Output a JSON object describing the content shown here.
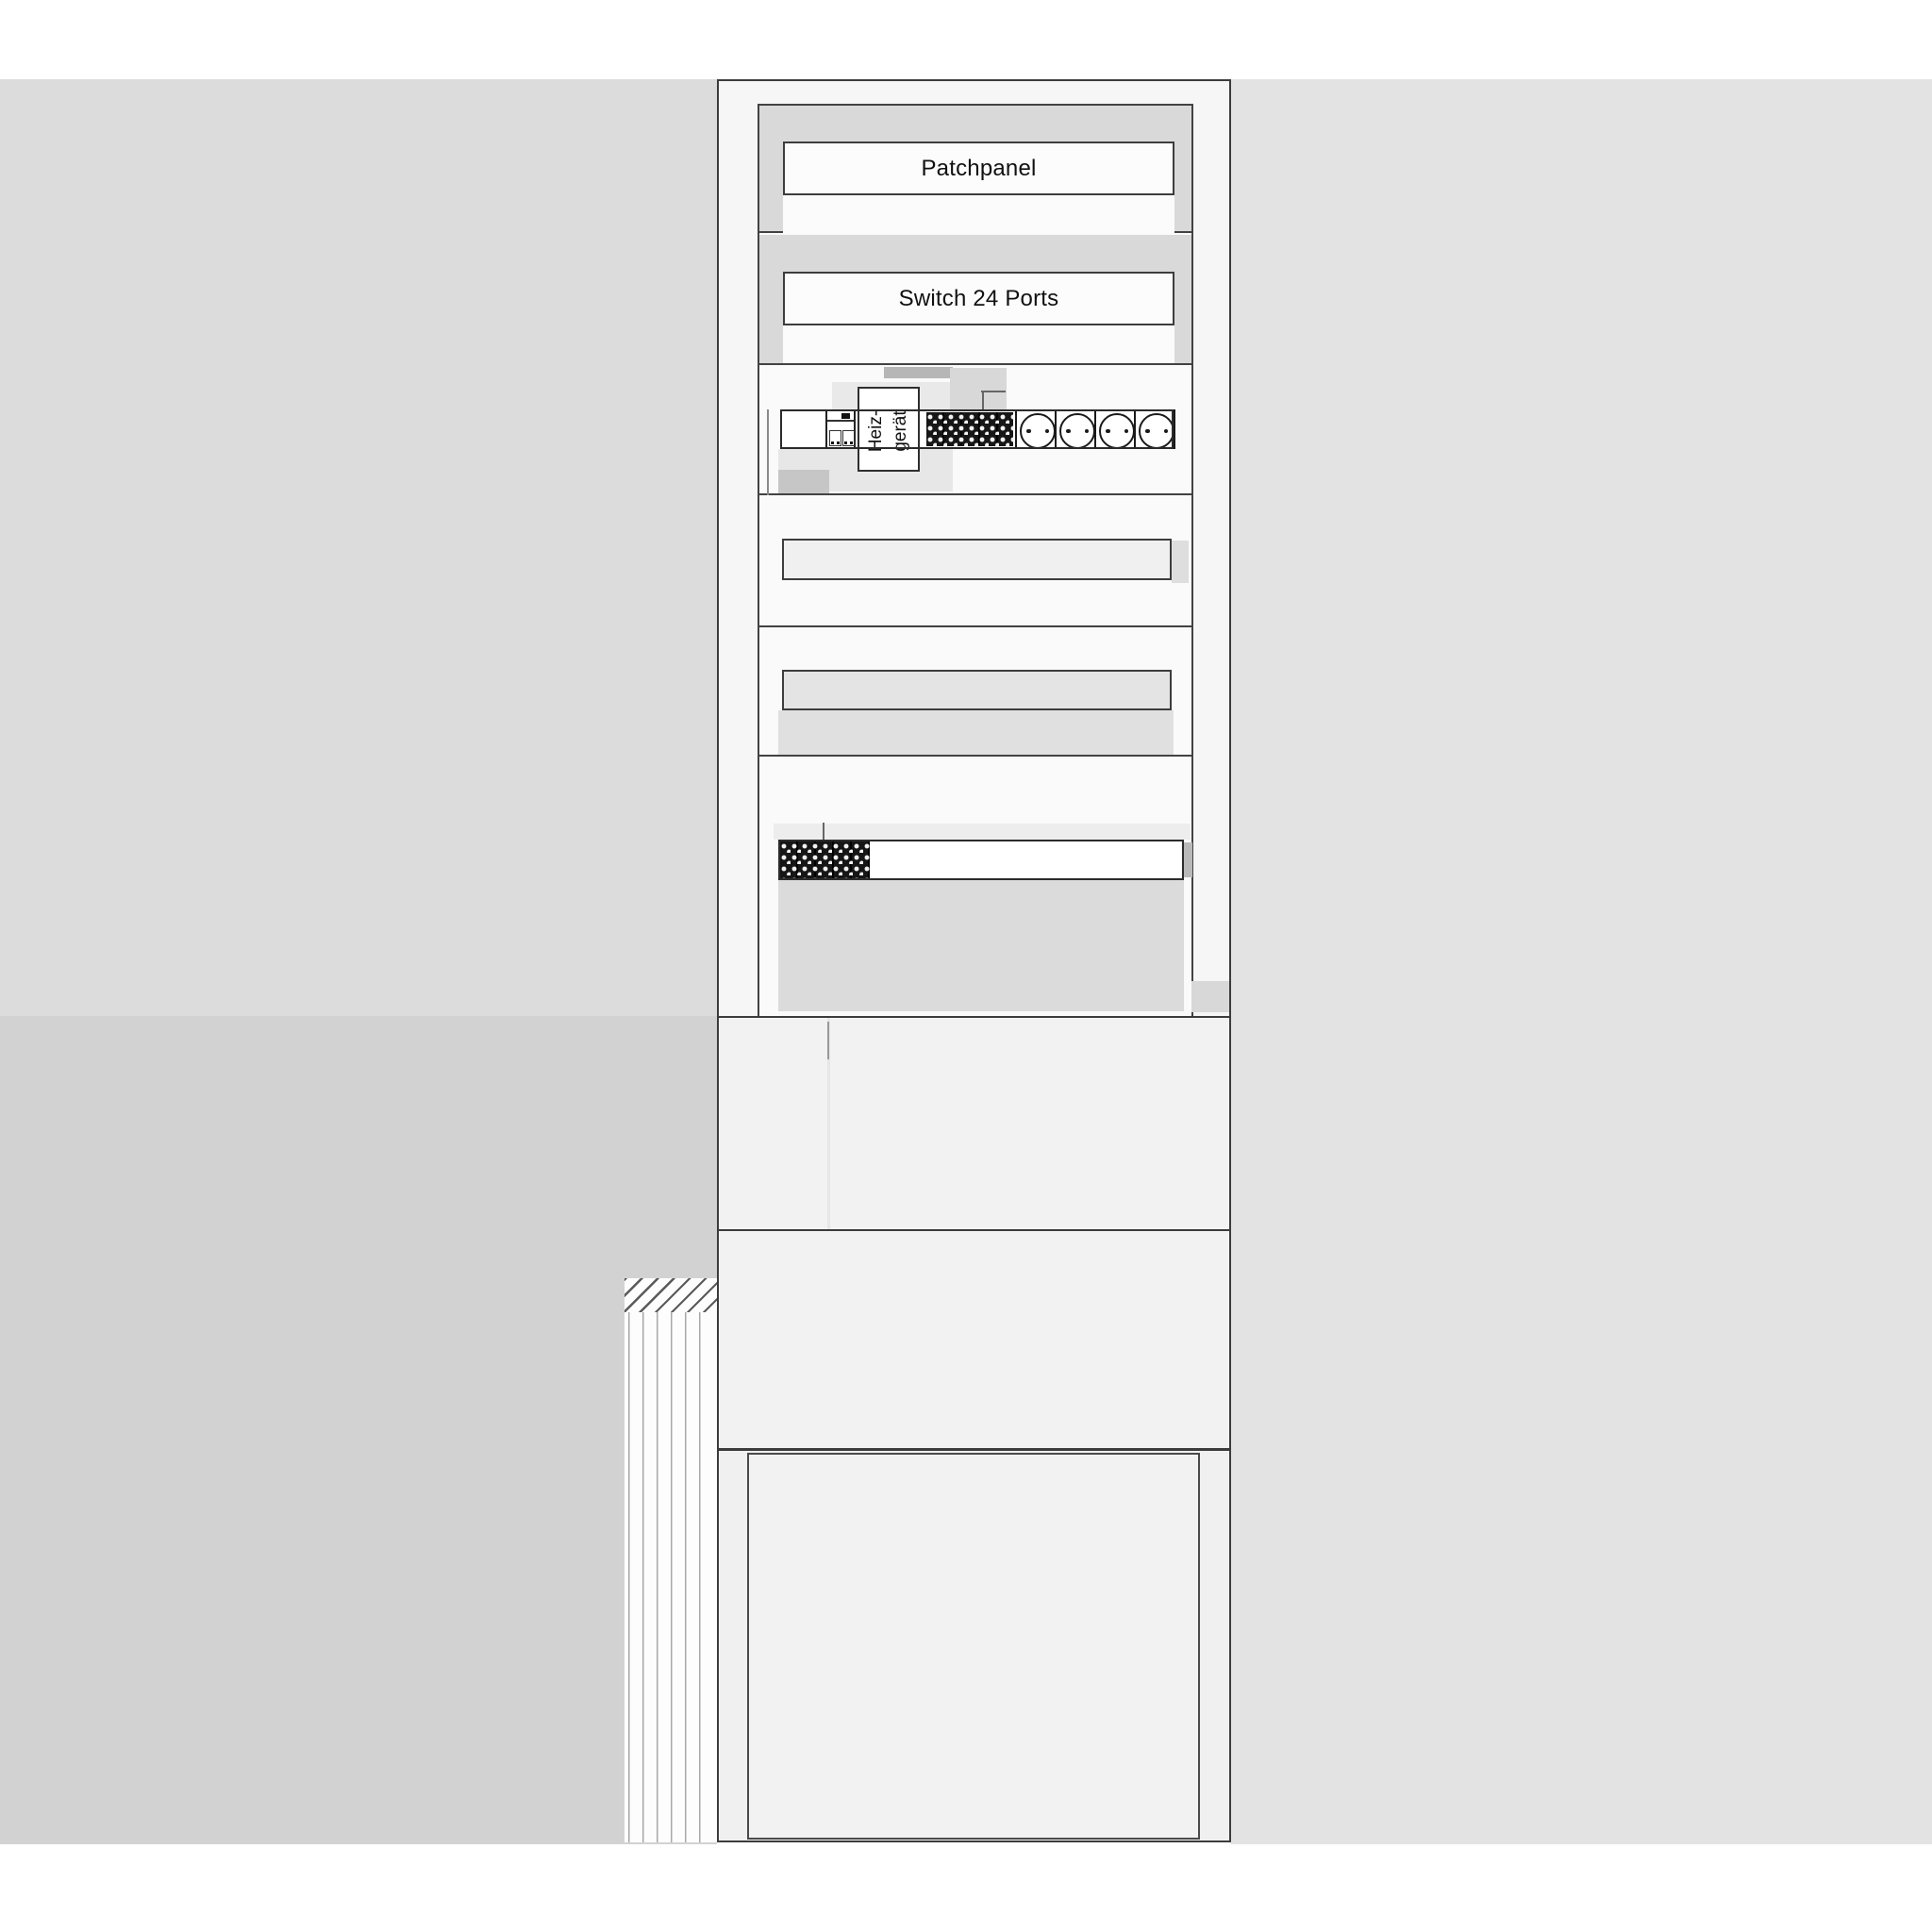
{
  "diagram": {
    "type": "network-cabinet-elevation-schematic",
    "labels": {
      "patchpanel": "Patchpanel",
      "switch": "Switch 24 Ports",
      "heater_line1": "Heiz-",
      "heater_line2": "gerät"
    },
    "rack_units": [
      {
        "name": "patchpanel",
        "label": "Patchpanel"
      },
      {
        "name": "switch",
        "label": "Switch 24 Ports"
      },
      {
        "name": "power-strip",
        "label": "Heiz-gerät",
        "parts": [
          "circuit-breaker-module",
          "heater-label",
          "vent-grille",
          "schuko-socket x4"
        ]
      },
      {
        "name": "blank-module-row",
        "label": ""
      },
      {
        "name": "blank-module-row",
        "label": ""
      },
      {
        "name": "device-strip-with-vent",
        "label": ""
      }
    ],
    "icons": {
      "vent_grille": "black panel with white dot matrix",
      "schuko_socket": "circle with two contact holes",
      "wall_hatch": "diagonal masonry hatching"
    },
    "colors": {
      "page_background": "#ffffff",
      "background_left_upper": "#dcdcdc",
      "background_left_lower": "#d2d2d2",
      "background_right": "#e3e3e3",
      "cabinet_fill": "#f6f6f6",
      "rack_band_grey": "#d9d9d9",
      "section_fill": "#f2f2f2",
      "module_fill_light": "#f0f0f0",
      "module_fill_grey": "#e4e4e4",
      "shadow_grey_dark": "#b6b6b6",
      "shadow_grey_mid": "#c6c6c6",
      "grille_black": "#161616",
      "outline": "#3c3c3c",
      "text": "#111111"
    }
  }
}
